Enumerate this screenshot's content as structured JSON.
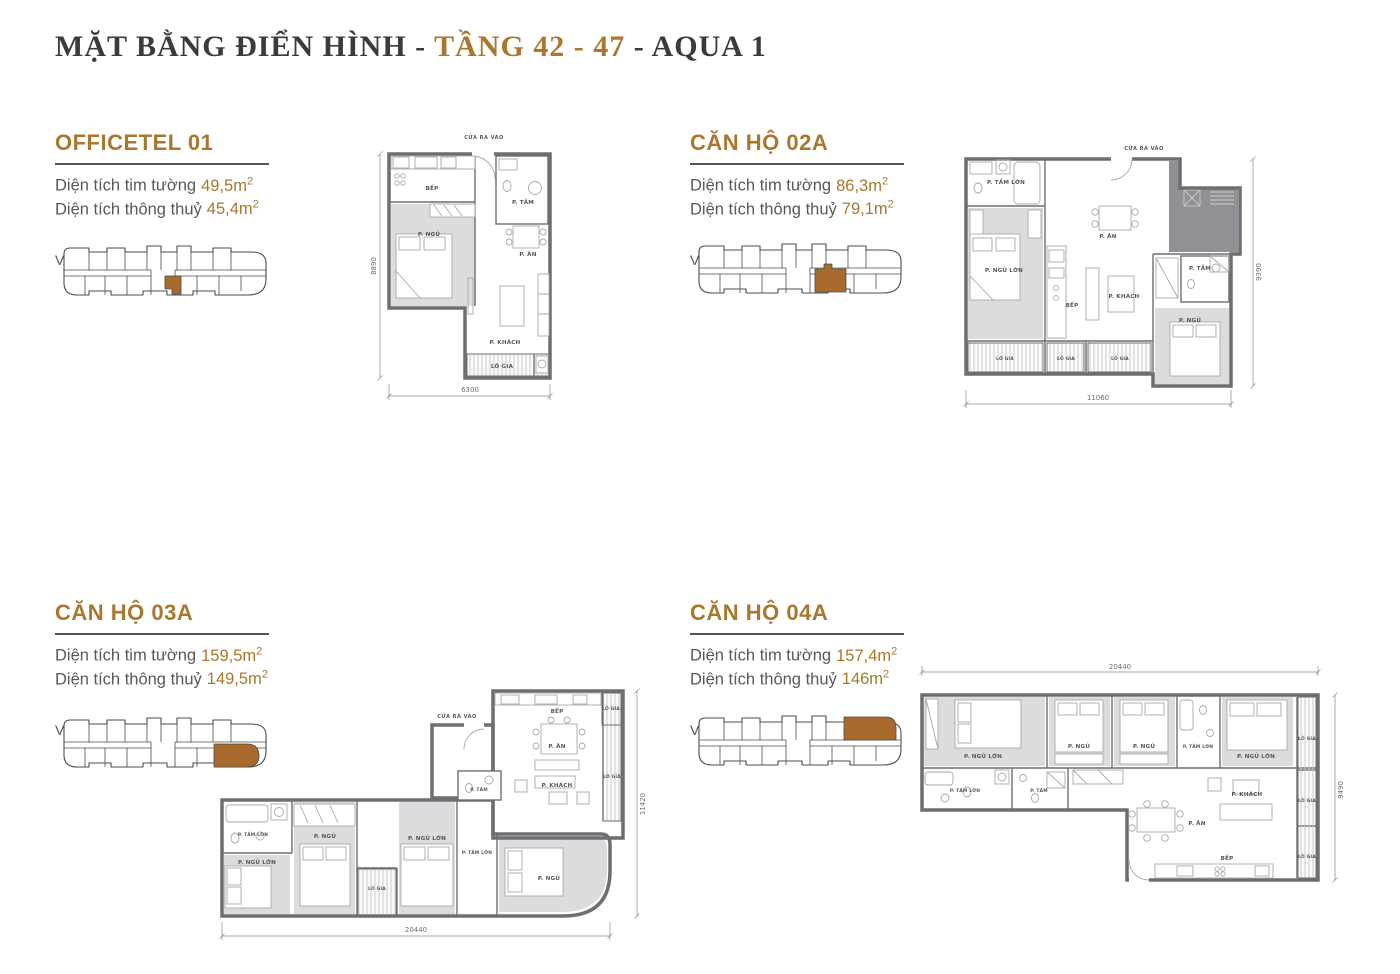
{
  "header": {
    "title_prefix": "MẶT BẰNG ĐIỂN HÌNH - ",
    "title_accent": "TẦNG 42 - 47",
    "title_suffix": " - AQUA 1"
  },
  "labels": {
    "area_wall": "Diện tích tim tường",
    "area_clear": "Diện tích thông thuỷ",
    "location": "Vị trí căn hộ",
    "entrance": "CỬA RA VÀO",
    "sup": "2"
  },
  "colors": {
    "accent": "#A9772D",
    "highlight": "#A96A2E",
    "title_dark": "#3B3B3C",
    "body_gray": "#58585A",
    "wall_gray": "#6D6E71",
    "room_fill": "#DBDCDD"
  },
  "units": {
    "officetel01": {
      "name": "OFFICETEL 01",
      "area_wall_value": "49,5m",
      "area_clear_value": "45,4m",
      "dim_width": "6300",
      "dim_height": "8890",
      "rooms": {
        "kitchen": "BẾP",
        "bath": "P. TẮM",
        "bedroom": "P. NGỦ",
        "dining": "P. ĂN",
        "living": "P. KHÁCH",
        "loggia": "LÔ GIA"
      }
    },
    "canho02a": {
      "name": "CĂN HỘ 02A",
      "area_wall_value": "86,3m",
      "area_clear_value": "79,1m",
      "dim_width": "11060",
      "dim_height": "9390",
      "rooms": {
        "bath_large": "P. TẮM LỚN",
        "bedroom_large": "P. NGỦ LỚN",
        "dining": "P. ĂN",
        "kitchen": "BẾP",
        "living": "P. KHÁCH",
        "bath": "P. TẮM",
        "bedroom": "P. NGỦ",
        "loggia": "LÔ GIA"
      }
    },
    "canho03a": {
      "name": "CĂN HỘ 03A",
      "area_wall_value": "159,5m",
      "area_clear_value": "149,5m",
      "dim_width": "20440",
      "dim_height": "11420",
      "rooms": {
        "kitchen": "BẾP",
        "dining": "P. ĂN",
        "living": "P. KHÁCH",
        "bath": "P. TẮM",
        "bath_large": "P. TẮM LỚN",
        "bedroom_large": "P. NGỦ LỚN",
        "bedroom": "P. NGỦ",
        "loggia": "LÔ GIA"
      }
    },
    "canho04a": {
      "name": "CĂN HỘ 04A",
      "area_wall_value": "157,4m",
      "area_clear_value": "146m",
      "dim_width": "20440",
      "dim_height": "9490",
      "rooms": {
        "bedroom_large": "P. NGỦ LỚN",
        "bedroom": "P. NGỦ",
        "bath_large": "P. TẮM LỚN",
        "bath": "P. TẮM",
        "dining": "P. ĂN",
        "living": "P. KHÁCH",
        "kitchen": "BẾP",
        "loggia": "LÔ GIA"
      }
    }
  }
}
